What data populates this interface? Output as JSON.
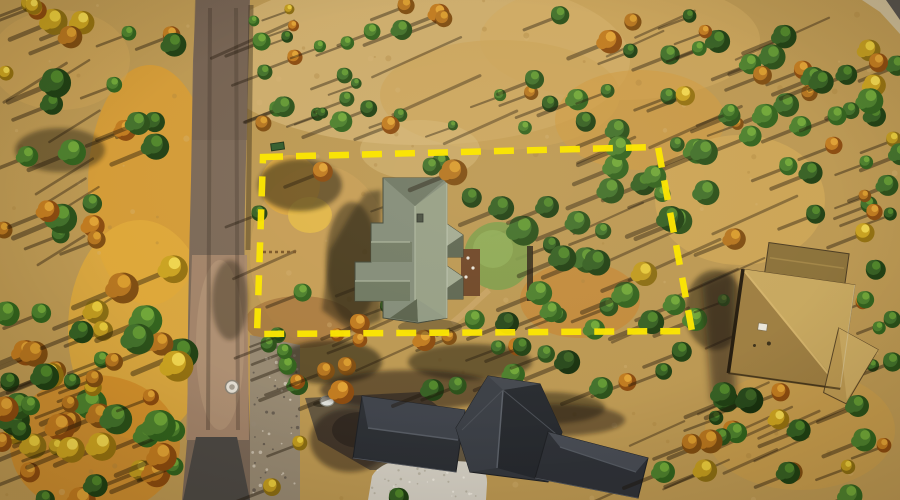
{
  "meta": {
    "type": "aerial-drone-photo",
    "description": "Aerial drone photo of a forested residential lot outlined with a yellow dashed property boundary; a gray-green roofed house sits inside the lot, a dirt-and-asphalt road runs along the left, a dark charcoal-roofed house is at the bottom, and a tan shingle-roofed house is at the right edge, surrounded by green pines and orange autumn trees with long diagonal shadows.",
    "width": 900,
    "height": 500
  },
  "scene": {
    "palette": {
      "ground_base": "#bb9751",
      "ground_light": "#d2b273",
      "grass_orange": "#d79a30",
      "dirt_brown": "#9c6b35",
      "road_surface": "#7a6756",
      "road_dirt": "#a5856a",
      "road_asphalt": "#4c4843",
      "gravel": "#8f8577",
      "driveway": "#d3cec2",
      "main_roof": "#828b78",
      "bottom_roof": "#33363c",
      "right_roof": "#b3914c",
      "lawn_green": "#7e9c49",
      "tree_green": "#41702a",
      "tree_autumn": "#c07a1e",
      "tree_yellow": "#e6c83a",
      "shadow": "#1c140a",
      "boundary_yellow": "#fbe503",
      "manhole": "#e2ddd2"
    },
    "boundary": {
      "color": "#fbe503",
      "corners": [
        [
          263,
          157
        ],
        [
          658,
          147
        ],
        [
          692,
          331
        ],
        [
          257,
          334
        ]
      ],
      "dash_on": 20,
      "dash_off": 13,
      "stroke_width": 6.5
    }
  }
}
